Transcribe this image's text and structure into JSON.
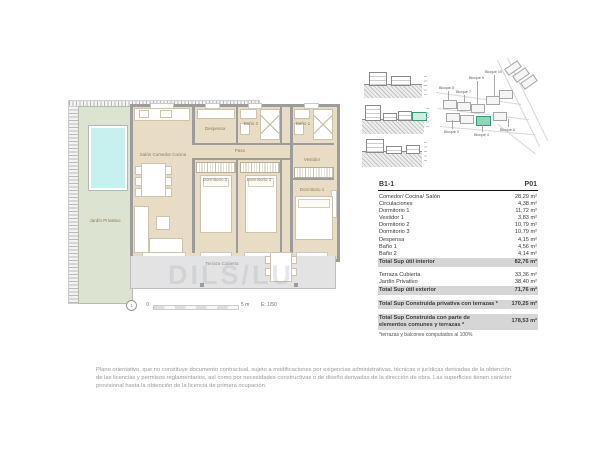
{
  "document": {
    "watermark": "DILS/LU",
    "disclaimer": "Plano orientativo, que no constituye documento contractual, sujeto a modificaciones por exigencias administrativas, técnicas o jurídicas derivadas de la obtención de las licencias y permisos reglamentarios, así como por necesidades constructivas o de diseño derivadas de la dirección de obra. Las superficies tienen carácter provisional hasta la obtención de la licencia de primera ocupación."
  },
  "floor_plan": {
    "rooms": {
      "living": "Salón Comedor Cocina",
      "despensa": "Despensa",
      "bano2": "Baño 2",
      "bano1": "Baño 1",
      "paso": "Paso",
      "dormitorio2": "Dormitorio 2",
      "dormitorio3": "Dormitorio 3",
      "vestidor": "Vestidor",
      "dormitorio1": "Dormitorio 1",
      "jardin": "Jardín Privativo",
      "terraza": "Terraza Cubierta"
    },
    "scale_bar": {
      "north_mark": "1",
      "zero": "0",
      "end": "5 m",
      "scale": "E: 1/50"
    }
  },
  "site_plan": {
    "labels": [
      "Bloque 5",
      "Bloque 7",
      "Bloque 9",
      "Bloque 10",
      "Bloque 3",
      "Bloque 4",
      "Bloque 6"
    ]
  },
  "area_table": {
    "unit_code": "B1-1",
    "floor_code": "P01",
    "interior_rows": [
      {
        "label": "Comedor/ Cocina/ Salón",
        "value": "28,29 m²"
      },
      {
        "label": "Circulaciones",
        "value": "4,38 m²"
      },
      {
        "label": "Dormitorio 1",
        "value": "11,72 m²"
      },
      {
        "label": "Vestidor 1",
        "value": "3,83 m²"
      },
      {
        "label": "Dormitorio 2",
        "value": "10,79 m²"
      },
      {
        "label": "Dormitorio 3",
        "value": "10,79 m²"
      },
      {
        "label": "Despensa",
        "value": "4,15 m²"
      },
      {
        "label": "Baño 1",
        "value": "4,56 m²"
      },
      {
        "label": "Baño 2",
        "value": "4,14 m²"
      }
    ],
    "interior_total": {
      "label": "Total Sup útil interior",
      "value": "82,76 m²"
    },
    "exterior_rows": [
      {
        "label": "Terraza Cubierta",
        "value": "33,36 m²"
      },
      {
        "label": "Jardín Privativo",
        "value": "38,40 m²"
      }
    ],
    "exterior_total": {
      "label": "Total Sup útil exterior",
      "value": "71,76 m²"
    },
    "built_private_total": {
      "label": "Total Sup Construida privativa con terrazas *",
      "value": "170,25 m²"
    },
    "built_common_total": {
      "label": "Total Sup Construida con parte de elementos comunes y terrazas *",
      "value": "178,53 m²"
    },
    "footnote": "*terrazas y balcones computados al 100%"
  },
  "colors": {
    "wall": "#9c9c9c",
    "floor": "#e9dcc5",
    "garden": "#dce3d0",
    "pool": "#c6f1ef",
    "terrace": "#e3e3e3",
    "highlight_green": "#2f9e77",
    "total_row_bg": "#d6d6d6"
  }
}
